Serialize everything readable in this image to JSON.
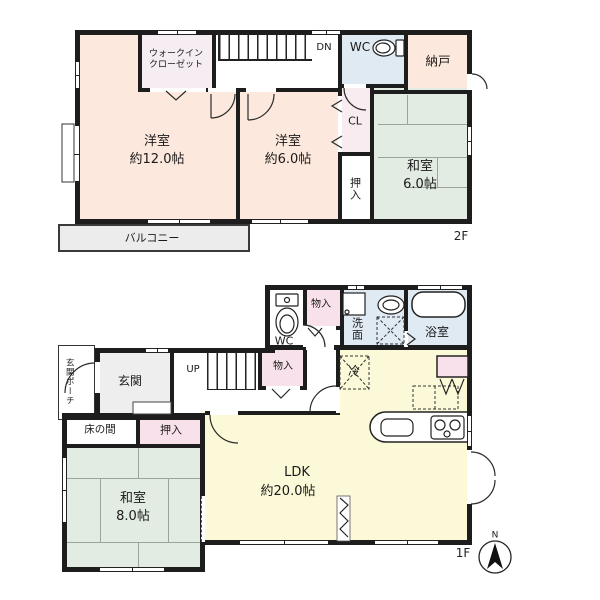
{
  "floor2": {
    "label": "2F",
    "rooms": {
      "wic_line1": "ウォークイン",
      "wic_line2": "クローゼット",
      "stairs_dn": "DN",
      "wc": "WC",
      "nando": "納戸",
      "bedroom12_name": "洋室",
      "bedroom12_size": "約12.0帖",
      "bedroom6_name": "洋室",
      "bedroom6_size": "約6.0帖",
      "closet": "CL",
      "oshiire": "押入",
      "washitsu_name": "和室",
      "washitsu_size": "6.0帖",
      "balcony": "バルコニー"
    }
  },
  "floor1": {
    "label": "1F",
    "compass": "N",
    "rooms": {
      "wc": "WC",
      "storage_top": "物入",
      "washroom": "洗面",
      "bathroom": "浴室",
      "porch": "玄関ポーチ",
      "entrance": "玄関",
      "stairs_up": "UP",
      "storage_hall": "物入",
      "fridge": "冷",
      "tokonoma": "床の間",
      "oshiire": "押入",
      "washitsu_name": "和室",
      "washitsu_size": "8.0帖",
      "ldk_name": "LDK",
      "ldk_size": "約20.0帖"
    }
  },
  "colors": {
    "wall": "#1d1d1d",
    "western_room": "#fce8dc",
    "tatami_room": "#e3ece2",
    "wet_area": "#e0eaf2",
    "storage_pink": "#f8e1ea",
    "closet_lavender": "#f6edf3",
    "ldk_yellow": "#fcf9d8",
    "balcony_gray": "#ececec",
    "entrance_gray": "#eeeeee"
  }
}
